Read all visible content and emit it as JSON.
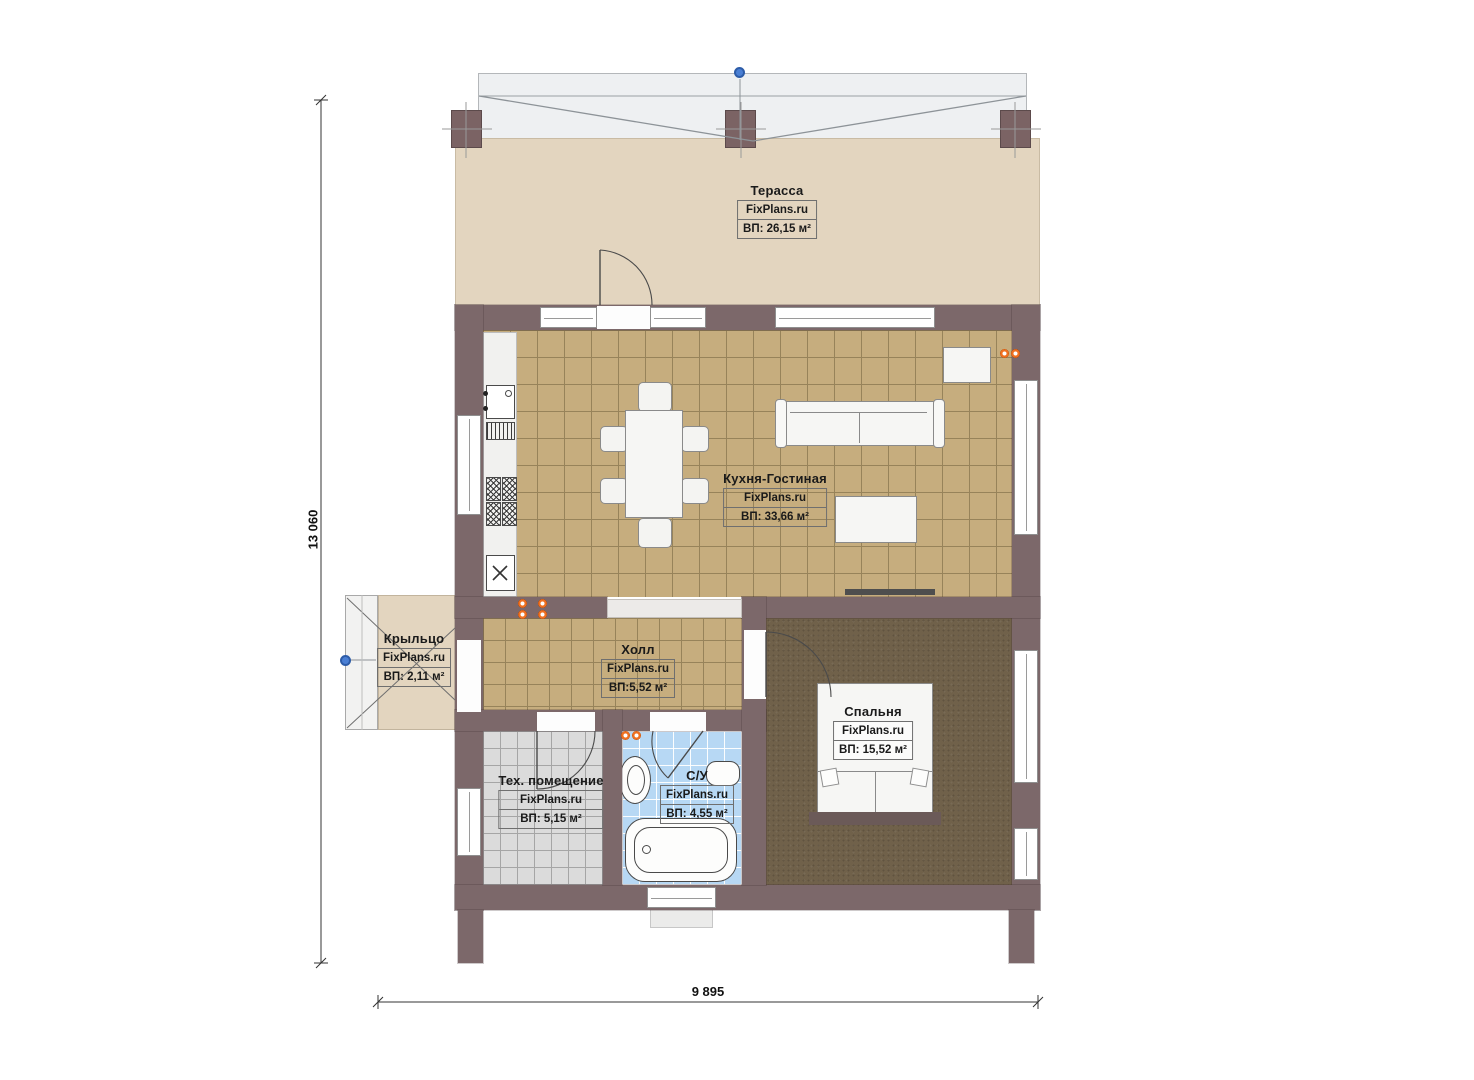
{
  "plan": {
    "watermark": "FixPlans.ru",
    "dimension_height": "13 060",
    "dimension_width": "9 895",
    "rooms": {
      "terrace": {
        "name": "Терасса",
        "area": "ВП: 26,15 м²"
      },
      "kitchen_living": {
        "name": "Кухня-Гостиная",
        "area": "ВП: 33,66 м²"
      },
      "porch": {
        "name": "Крыльцо",
        "area": "ВП: 2,11 м²"
      },
      "hall": {
        "name": "Холл",
        "area": "ВП:5,52 м²"
      },
      "bedroom": {
        "name": "Спальня",
        "area": "ВП: 15,52 м²"
      },
      "tech_room": {
        "name": "Тех. помещение",
        "area": "ВП: 5,15 м²"
      },
      "bathroom": {
        "name": "С/У",
        "area": "ВП: 4,55 м²"
      }
    },
    "colors": {
      "wall": "#7c686a",
      "floor_tile": "#c6ad7e",
      "terrace_floor": "#e3d5bf",
      "bedroom_floor": "#70614a",
      "tech_floor": "#dbdbdb",
      "bath_floor": "#b7d8f4",
      "socket_accent": "#f07020",
      "handle_blue": "#4a7fd4"
    }
  }
}
